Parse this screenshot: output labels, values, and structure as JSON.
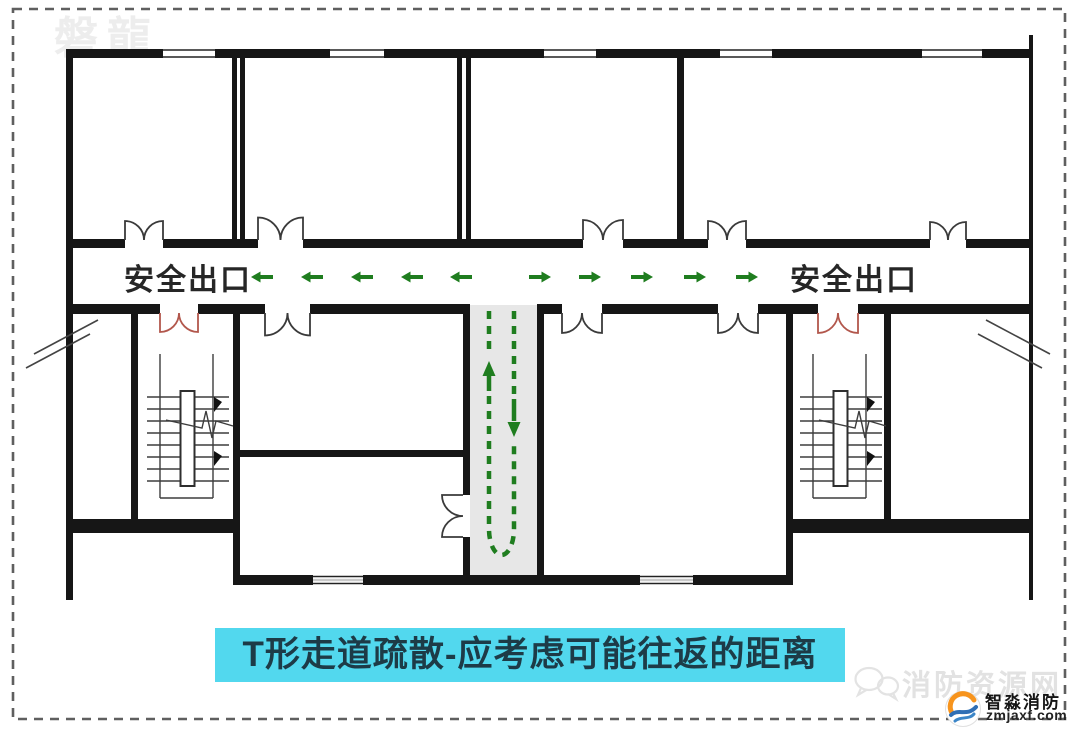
{
  "page": {
    "background": "#ffffff",
    "border_color": "#5f5f5f"
  },
  "watermark_top": {
    "text": "磐龍"
  },
  "plan": {
    "exit_label_left": "安全出口",
    "exit_label_right": "安全出口",
    "colors": {
      "wall": "#161616",
      "door": "#3a3a3a",
      "exit_door": "#b2574c",
      "route_green": "#1f7d1f",
      "corridor_fill": "#e7e7e7"
    },
    "corridor_arrows": {
      "y": 277,
      "left_x": [
        262,
        312,
        362,
        412,
        461
      ],
      "right_x": [
        540,
        590,
        642,
        695,
        747
      ]
    }
  },
  "caption": {
    "text": "T形走道疏散-应考虑可能往返的距离",
    "bg": "#52d8ee",
    "color": "#1d3b47"
  },
  "footer": {
    "watermark_text": "消防资源网",
    "logo_title": "智淼消防",
    "logo_domain": "zmjaxf.com",
    "logo_colors": {
      "orange": "#f7941d",
      "blue": "#2f6fb5"
    }
  }
}
